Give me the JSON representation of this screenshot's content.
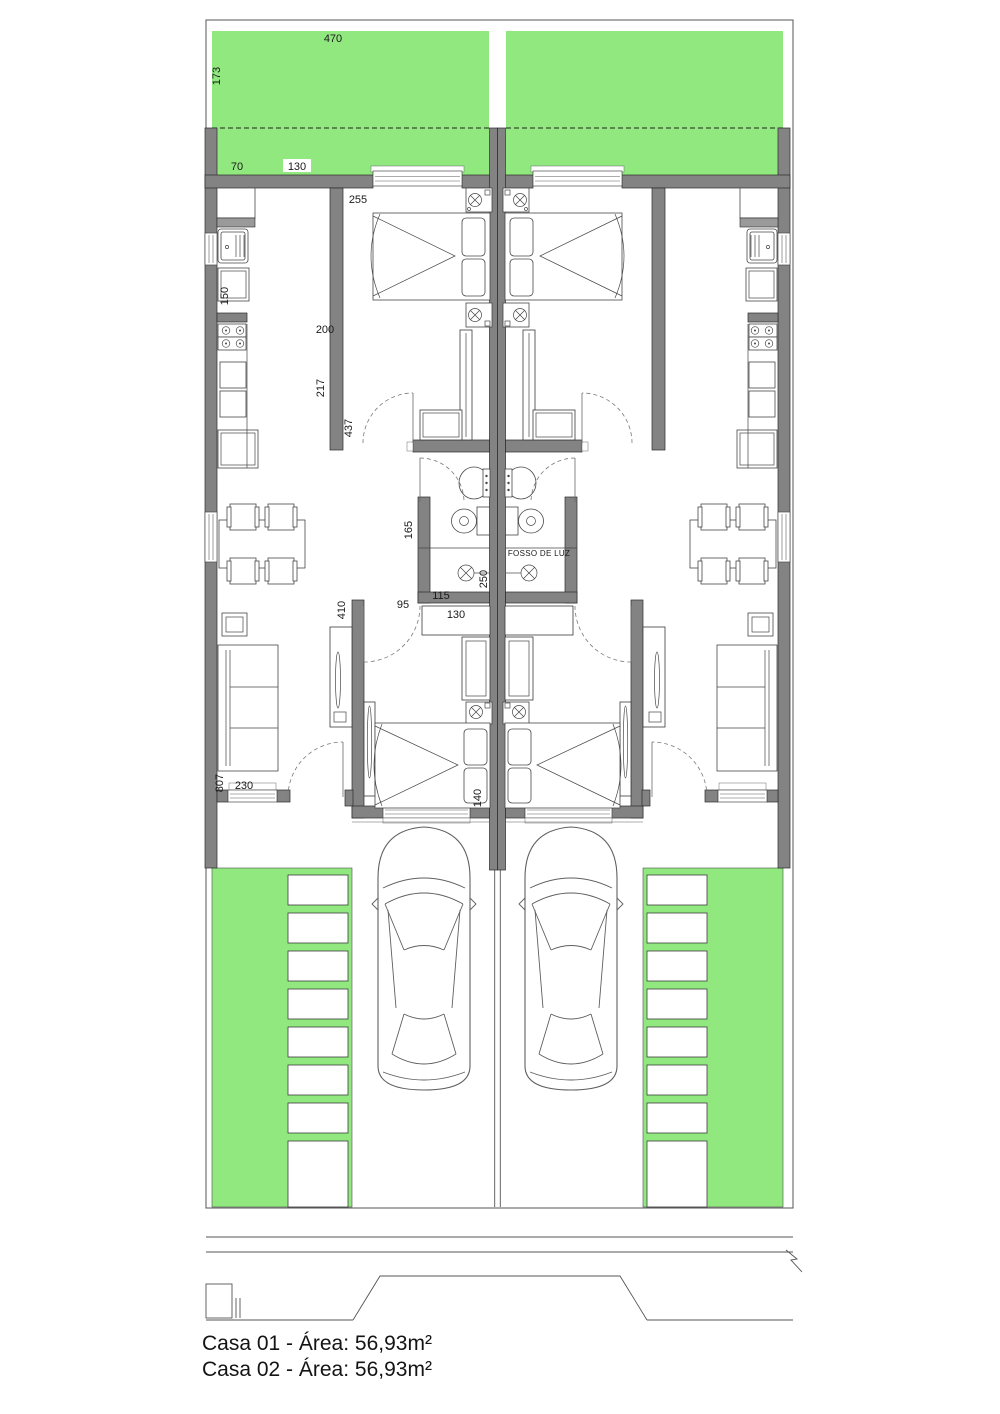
{
  "plan": {
    "colors": {
      "garden_green": "#90e87f",
      "wall_gray": "#838383",
      "line_dark": "#1f1f1f",
      "paving_white": "#ffffff"
    },
    "room_labels": {
      "fosso_de_luz": "FOSSO DE LUZ"
    },
    "dimensions": [
      {
        "name": "garden-width",
        "text": "470"
      },
      {
        "name": "garden-depth",
        "text": "173"
      },
      {
        "name": "front-setback",
        "text": "70"
      },
      {
        "name": "front-window",
        "text": "130"
      },
      {
        "name": "bedroom1-width",
        "text": "255"
      },
      {
        "name": "laundry",
        "text": "150"
      },
      {
        "name": "kitchen-width",
        "text": "200"
      },
      {
        "name": "kitchen-length",
        "text": "217"
      },
      {
        "name": "bedroom1-length",
        "text": "437"
      },
      {
        "name": "bath-width",
        "text": "165"
      },
      {
        "name": "bath-inner",
        "text": "115"
      },
      {
        "name": "bath-length",
        "text": "250"
      },
      {
        "name": "hall-door",
        "text": "95"
      },
      {
        "name": "bedroom2-length",
        "text": "410"
      },
      {
        "name": "closet-width",
        "text": "130"
      },
      {
        "name": "living-length",
        "text": "807"
      },
      {
        "name": "living-width",
        "text": "230"
      },
      {
        "name": "bedroom2-width",
        "text": "140"
      }
    ],
    "footer": {
      "casa1": "Casa 01 - Área: 56,93m²",
      "casa2": "Casa 02 - Área: 56,93m²"
    }
  }
}
